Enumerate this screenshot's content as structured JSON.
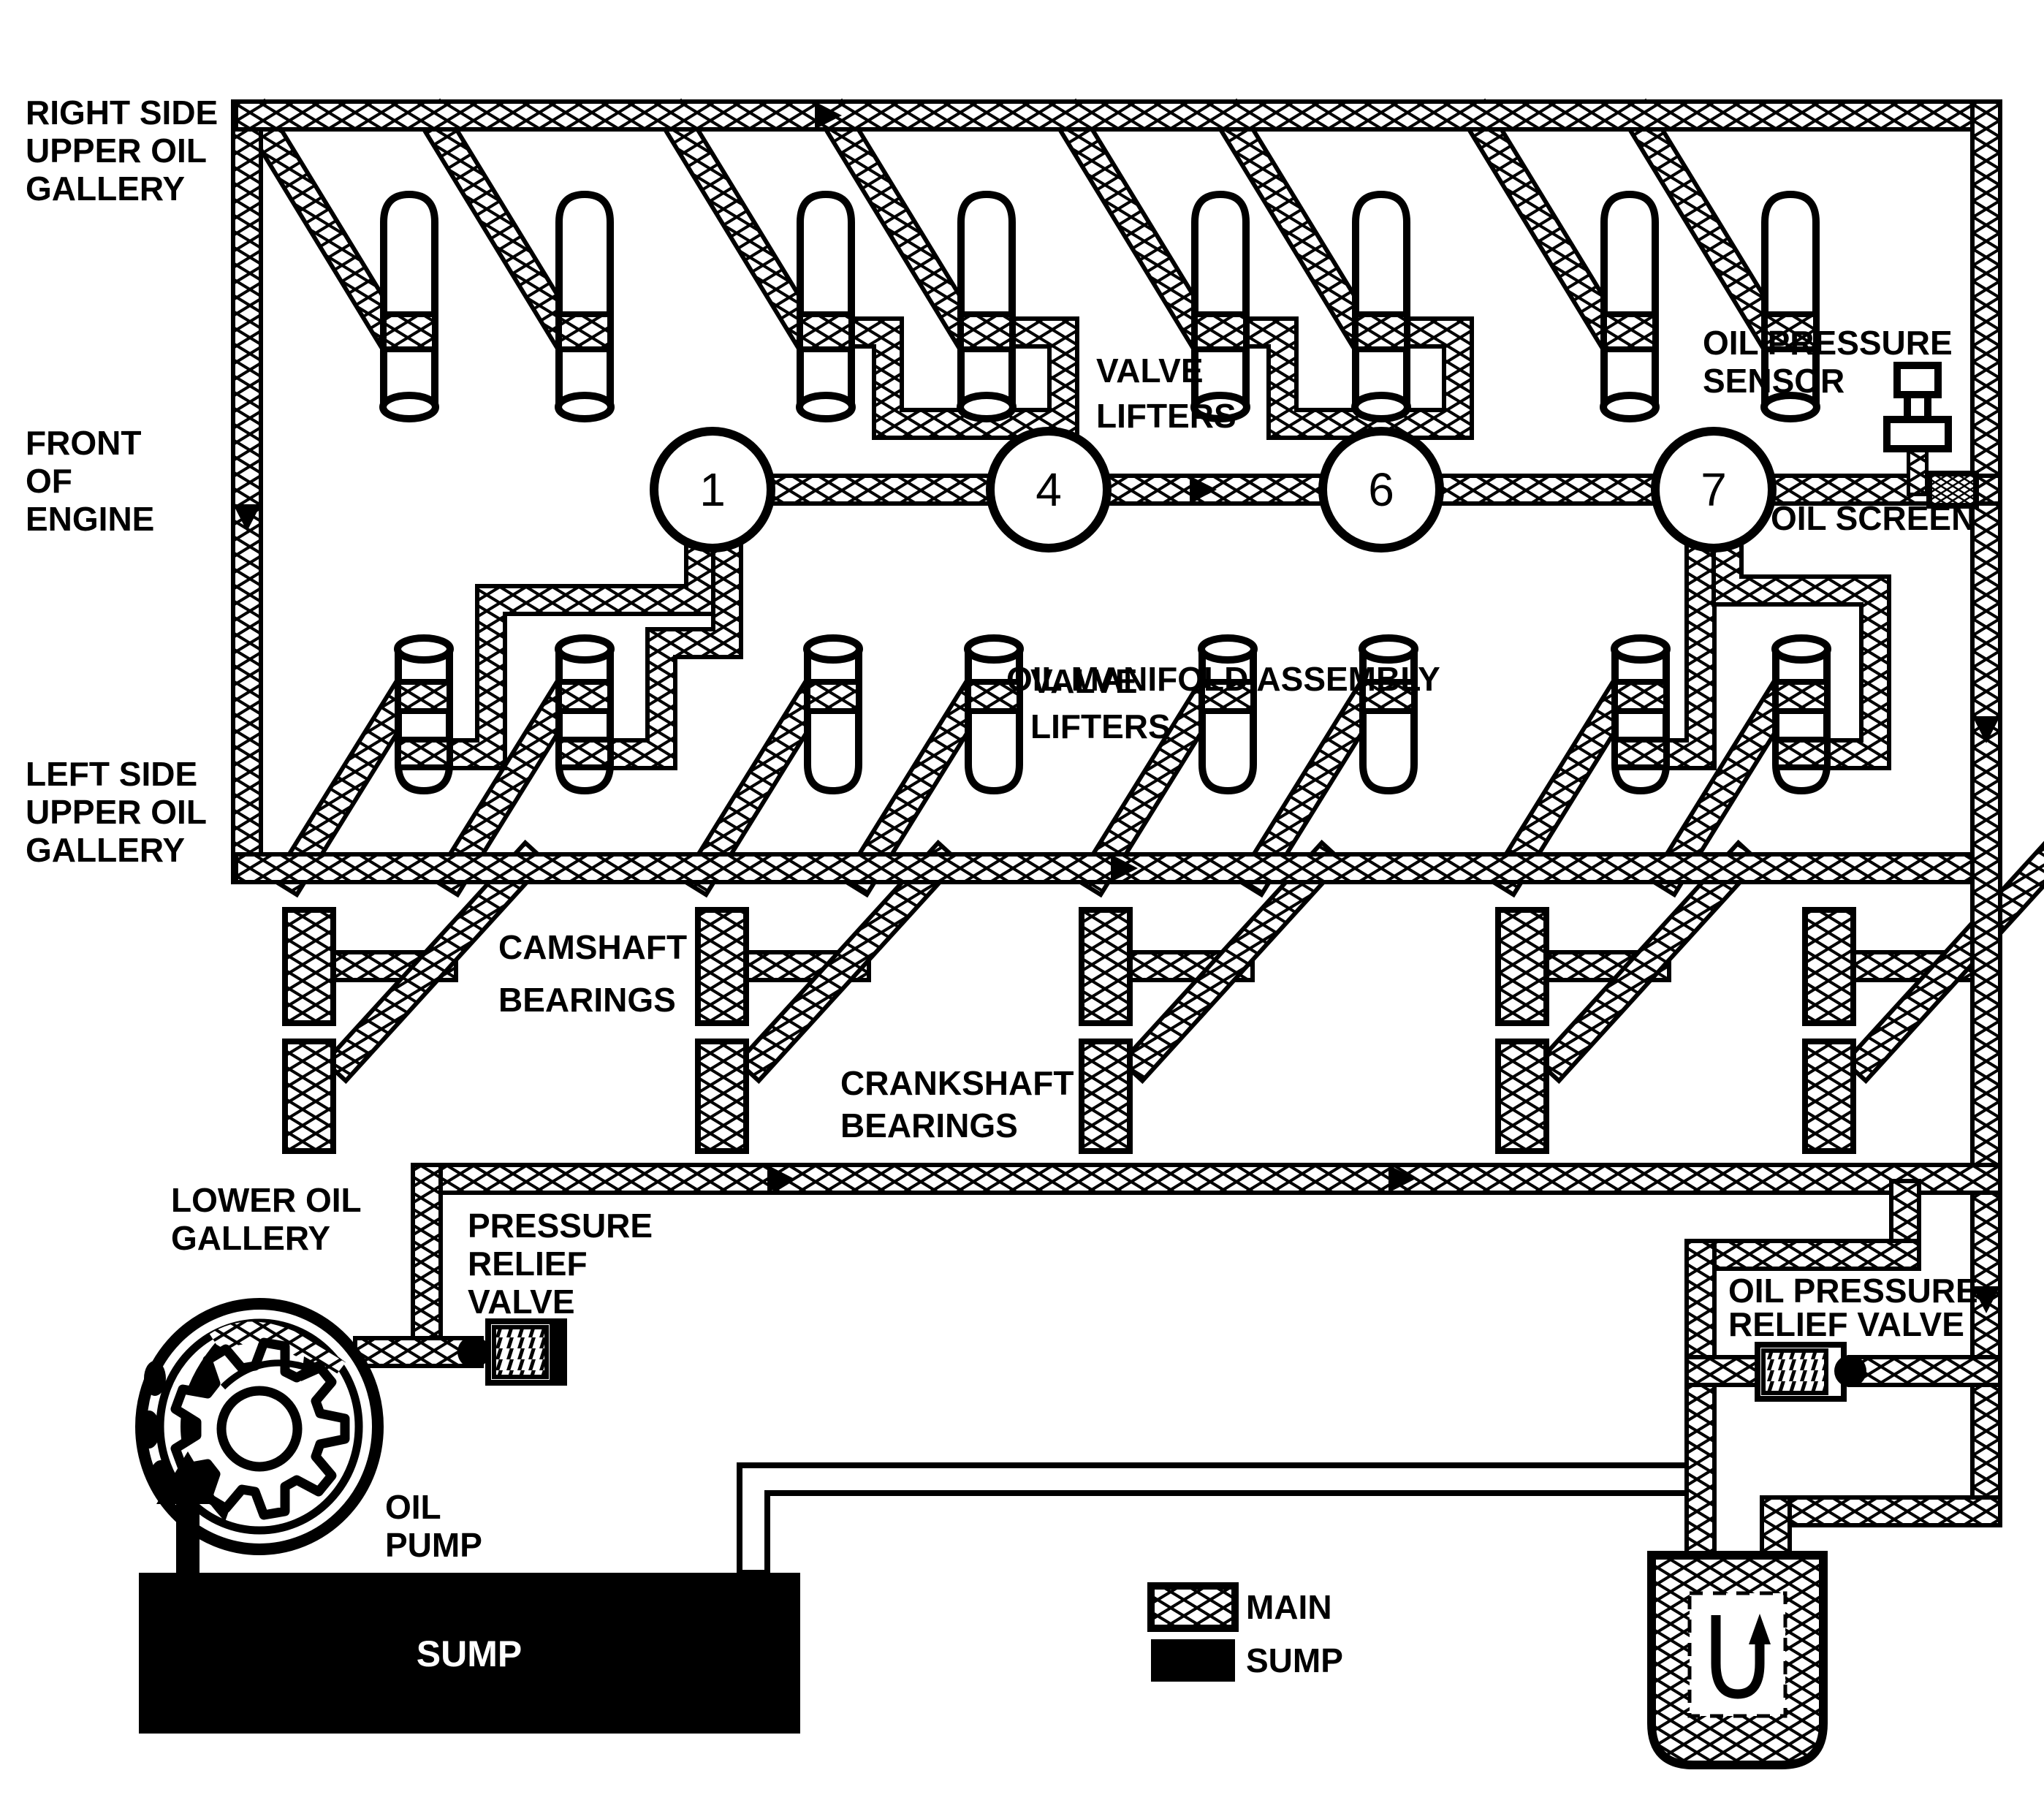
{
  "labels": {
    "right_gallery": [
      "RIGHT SIDE",
      "UPPER OIL",
      "GALLERY"
    ],
    "front_engine": [
      "FRONT",
      "OF",
      "ENGINE"
    ],
    "left_gallery": [
      "LEFT SIDE",
      "UPPER OIL",
      "GALLERY"
    ],
    "valve_lifters_top": [
      "VALVE",
      "LIFTERS"
    ],
    "valve_lifters_bottom": [
      "VALVE",
      "LIFTERS"
    ],
    "oil_manifold": "OIL MANIFOLD ASSEMBLY",
    "oil_pressure_sensor": [
      "OIL PRESSURE",
      "SENSOR"
    ],
    "oil_screen": "OIL SCREEN",
    "camshaft_bearings": [
      "CAMSHAFT",
      "BEARINGS"
    ],
    "crankshaft_bearings": [
      "CRANKSHAFT",
      "BEARINGS"
    ],
    "lower_oil_gallery": [
      "LOWER OIL",
      "GALLERY"
    ],
    "pressure_relief_valve": [
      "PRESSURE",
      "RELIEF",
      "VALVE"
    ],
    "oil_pump": [
      "OIL",
      "PUMP"
    ],
    "sump": "SUMP",
    "oil_pressure_relief_valve": [
      "OIL PRESSURE",
      "RELIEF VALVE"
    ]
  },
  "manifold_ports": [
    "1",
    "4",
    "6",
    "7"
  ],
  "legend": {
    "items": [
      {
        "swatch": "main-hatched",
        "label": "MAIN"
      },
      {
        "swatch": "sump-solid",
        "label": "SUMP"
      }
    ]
  },
  "colors": {
    "ink": "#000000",
    "paper": "#ffffff"
  }
}
